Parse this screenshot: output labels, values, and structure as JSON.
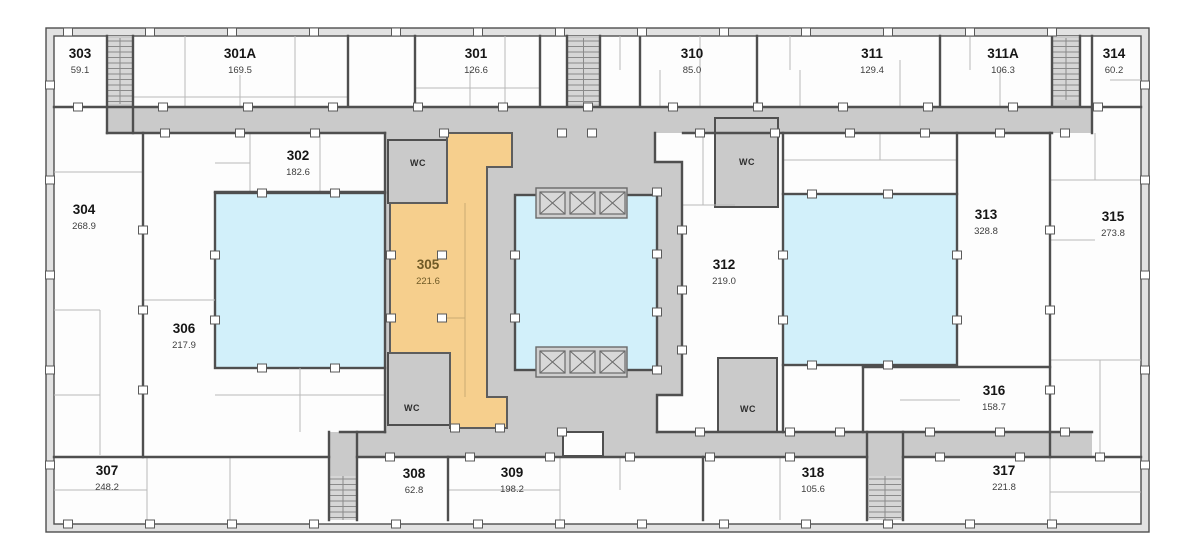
{
  "colors": {
    "wall": "#4f4f4f",
    "partition": "#b9b9b9",
    "corridor": "#cacaca",
    "room": "#fdfdfd",
    "blue": "#d2f0fa",
    "orange": "#f6cf8d"
  },
  "rooms": [
    {
      "id": "303",
      "number": "303",
      "area": "59.1",
      "x": 80,
      "y": 58,
      "highlight": "none"
    },
    {
      "id": "301A",
      "number": "301A",
      "area": "169.5",
      "x": 240,
      "y": 58,
      "highlight": "none"
    },
    {
      "id": "301",
      "number": "301",
      "area": "126.6",
      "x": 476,
      "y": 58,
      "highlight": "none"
    },
    {
      "id": "310",
      "number": "310",
      "area": "85.0",
      "x": 692,
      "y": 58,
      "highlight": "none"
    },
    {
      "id": "311",
      "number": "311",
      "area": "129.4",
      "x": 872,
      "y": 58,
      "highlight": "none"
    },
    {
      "id": "311A",
      "number": "311A",
      "area": "106.3",
      "x": 1003,
      "y": 58,
      "highlight": "none"
    },
    {
      "id": "314",
      "number": "314",
      "area": "60.2",
      "x": 1114,
      "y": 58,
      "highlight": "none"
    },
    {
      "id": "304",
      "number": "304",
      "area": "268.9",
      "x": 84,
      "y": 214,
      "highlight": "none"
    },
    {
      "id": "302",
      "number": "302",
      "area": "182.6",
      "x": 298,
      "y": 160,
      "highlight": "none"
    },
    {
      "id": "306",
      "number": "306",
      "area": "217.9",
      "x": 184,
      "y": 333,
      "highlight": "none"
    },
    {
      "id": "305",
      "number": "305",
      "area": "221.6",
      "x": 428,
      "y": 269,
      "highlight": "orange"
    },
    {
      "id": "312",
      "number": "312",
      "area": "219.0",
      "x": 724,
      "y": 269,
      "highlight": "none"
    },
    {
      "id": "313",
      "number": "313",
      "area": "328.8",
      "x": 986,
      "y": 219,
      "highlight": "none"
    },
    {
      "id": "315",
      "number": "315",
      "area": "273.8",
      "x": 1113,
      "y": 221,
      "highlight": "none"
    },
    {
      "id": "316",
      "number": "316",
      "area": "158.7",
      "x": 994,
      "y": 395,
      "highlight": "none"
    },
    {
      "id": "307",
      "number": "307",
      "area": "248.2",
      "x": 107,
      "y": 475,
      "highlight": "none"
    },
    {
      "id": "308",
      "number": "308",
      "area": "62.8",
      "x": 414,
      "y": 478,
      "highlight": "none"
    },
    {
      "id": "309",
      "number": "309",
      "area": "198.2",
      "x": 512,
      "y": 477,
      "highlight": "none"
    },
    {
      "id": "318",
      "number": "318",
      "area": "105.6",
      "x": 813,
      "y": 477,
      "highlight": "none"
    },
    {
      "id": "317",
      "number": "317",
      "area": "221.8",
      "x": 1004,
      "y": 475,
      "highlight": "none"
    }
  ],
  "wc_labels": [
    {
      "text": "WC",
      "x": 418,
      "y": 166
    },
    {
      "text": "WC",
      "x": 747,
      "y": 165
    },
    {
      "text": "WC",
      "x": 412,
      "y": 411
    },
    {
      "text": "WC",
      "x": 748,
      "y": 412
    }
  ],
  "highlighted_zones": [
    {
      "id": "zone-left",
      "color": "blue"
    },
    {
      "id": "zone-center-atrium",
      "color": "blue"
    },
    {
      "id": "zone-right",
      "color": "blue"
    },
    {
      "id": "room-305",
      "color": "orange"
    }
  ]
}
